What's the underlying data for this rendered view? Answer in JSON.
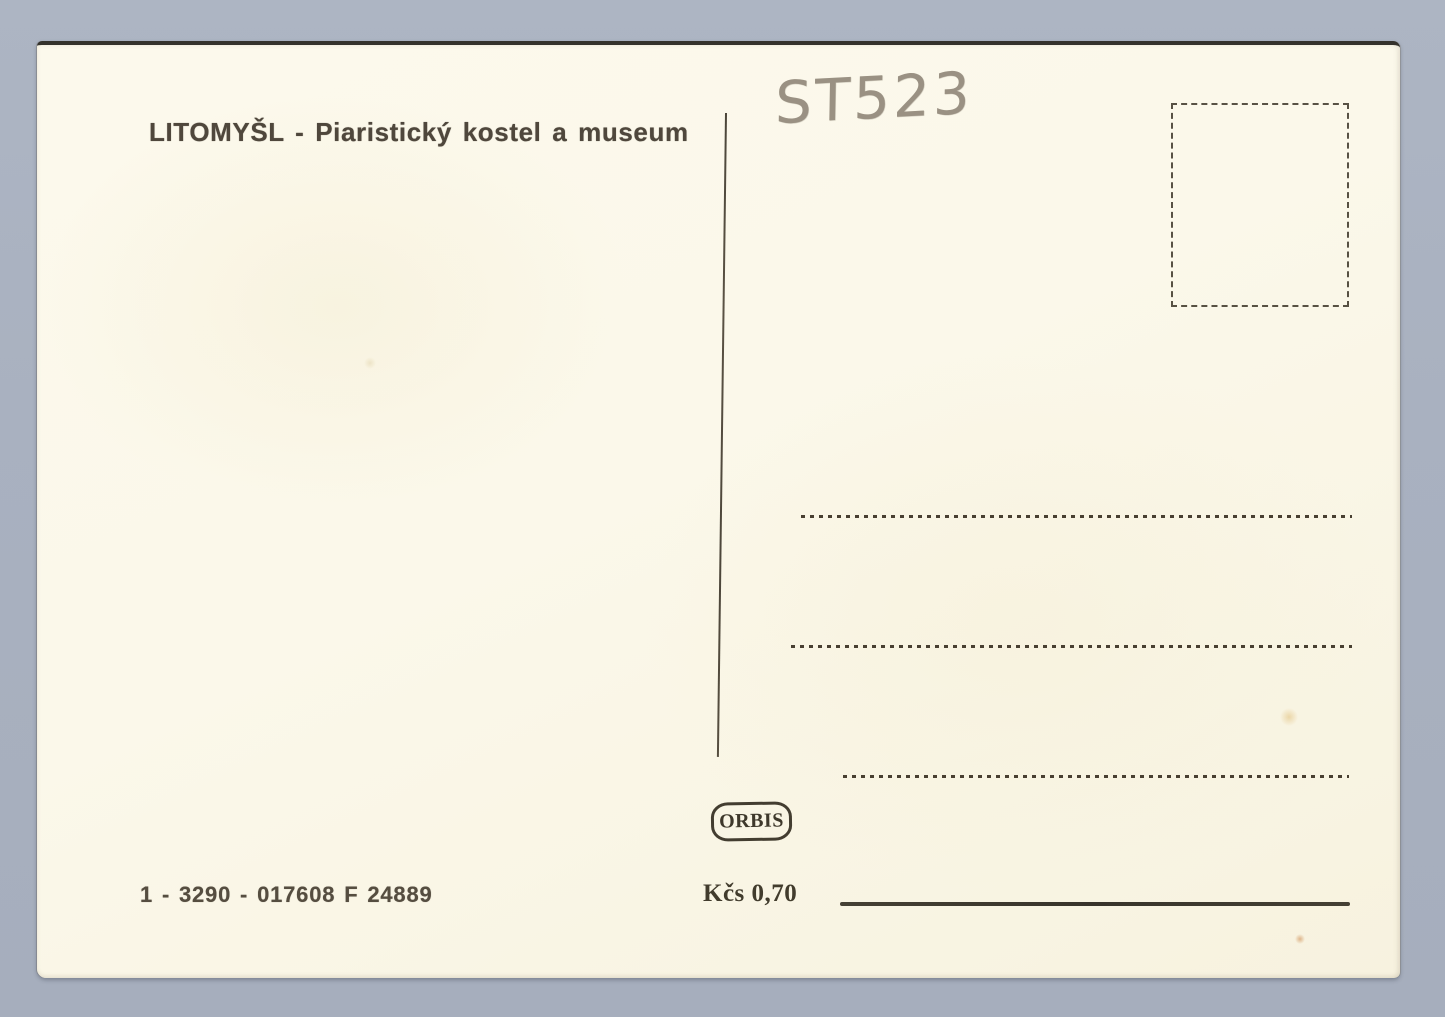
{
  "scene": {
    "description": "Scanned back of a vintage Czechoslovak postcard on a blue-gray backdrop"
  },
  "colors": {
    "bg": "#a9b1c0",
    "card": "#fbf8ea",
    "ink": "#4f473c",
    "ink-dark": "#3f3a30",
    "pencil": "#9a9183"
  },
  "card": {
    "caption": "LITOMYŠL - Piaristický kostel a museum",
    "handwritten_note": "ST523",
    "publisher": "ORBIS",
    "price": "Kčs 0,70",
    "catalog_number": "1 - 3290 - 017608 F 24889"
  }
}
